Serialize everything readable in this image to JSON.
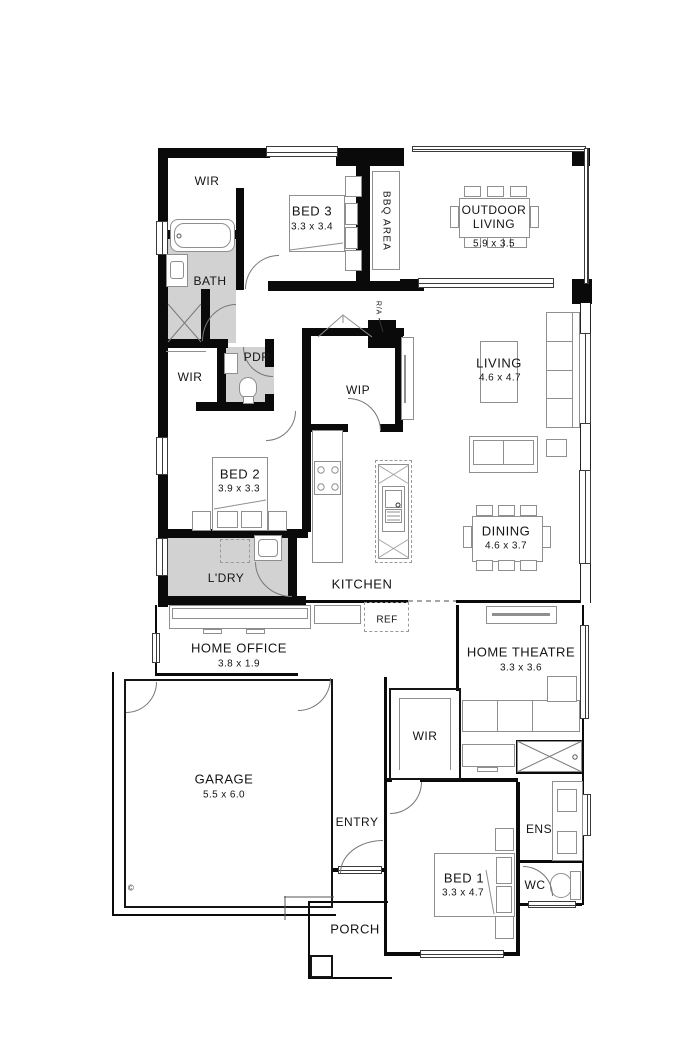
{
  "floor_plan": {
    "rooms": {
      "wir_top": {
        "label": "WIR"
      },
      "bed3": {
        "label": "BED 3",
        "dims": "3.3 x 3.4"
      },
      "outdoor": {
        "label": "OUTDOOR LIVING",
        "dims": "5.9 x 3.5"
      },
      "bath": {
        "label": "BATH"
      },
      "pdr": {
        "label": "PDR"
      },
      "wir_mid": {
        "label": "WIR"
      },
      "wip": {
        "label": "WIP"
      },
      "living": {
        "label": "LIVING",
        "dims": "4.6 x 4.7"
      },
      "bed2": {
        "label": "BED 2",
        "dims": "3.9 x 3.3"
      },
      "dining": {
        "label": "DINING",
        "dims": "4.6 x 3.7"
      },
      "ldry": {
        "label": "L'DRY"
      },
      "kitchen": {
        "label": "KITCHEN"
      },
      "home_office": {
        "label": "HOME OFFICE",
        "dims": "3.8 x 1.9"
      },
      "home_theatre": {
        "label": "HOME THEATRE",
        "dims": "3.3 x 3.6"
      },
      "garage": {
        "label": "GARAGE",
        "dims": "5.5 x 6.0"
      },
      "wir_bed1": {
        "label": "WIR"
      },
      "entry": {
        "label": "ENTRY"
      },
      "ens": {
        "label": "ENS"
      },
      "bed1": {
        "label": "BED 1",
        "dims": "3.3 x 4.7"
      },
      "wc": {
        "label": "WC"
      },
      "porch": {
        "label": "PORCH"
      }
    },
    "annotations": {
      "bbq_area": "BBQ AREA",
      "return_air": "R/A",
      "fridge": "REF",
      "copyright": "©"
    }
  },
  "colors": {
    "wall": "#0a0a0a",
    "wet_area_fill": "#d2d2d2",
    "furniture_line": "#8f8f8f",
    "background": "#ffffff"
  }
}
